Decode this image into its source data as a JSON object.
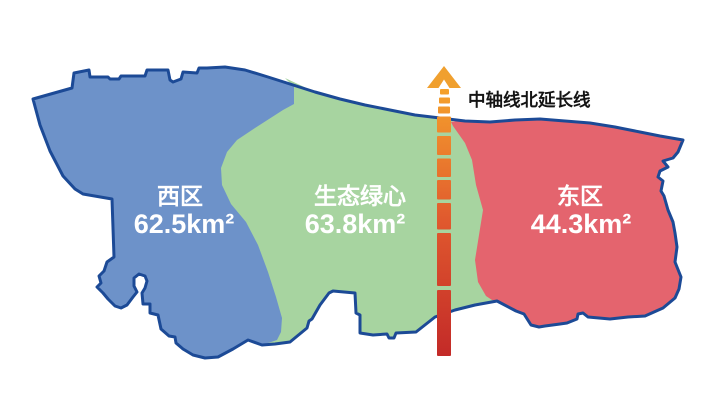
{
  "map": {
    "background": "#FFFFFF",
    "outline_color": "#1C4A96"
  },
  "axis": {
    "label": "中轴线北延长线",
    "label_color": "#141414",
    "arrow_color": "#F0A02F",
    "gradient_top": "#F6A42C",
    "gradient_mid": "#E0592E",
    "gradient_bottom": "#C32A28"
  },
  "regions": {
    "west": {
      "name": "西区",
      "area": "62.5km²",
      "color": "#6D92C9",
      "text_color": "#FFFFFF"
    },
    "green_heart": {
      "name": "生态绿心",
      "area": "63.8km²",
      "color": "#A7D4A0",
      "text_color": "#FFFFFF"
    },
    "east": {
      "name": "东区",
      "area": "44.3km²",
      "color": "#E4646E",
      "text_color": "#FFFFFF"
    }
  }
}
